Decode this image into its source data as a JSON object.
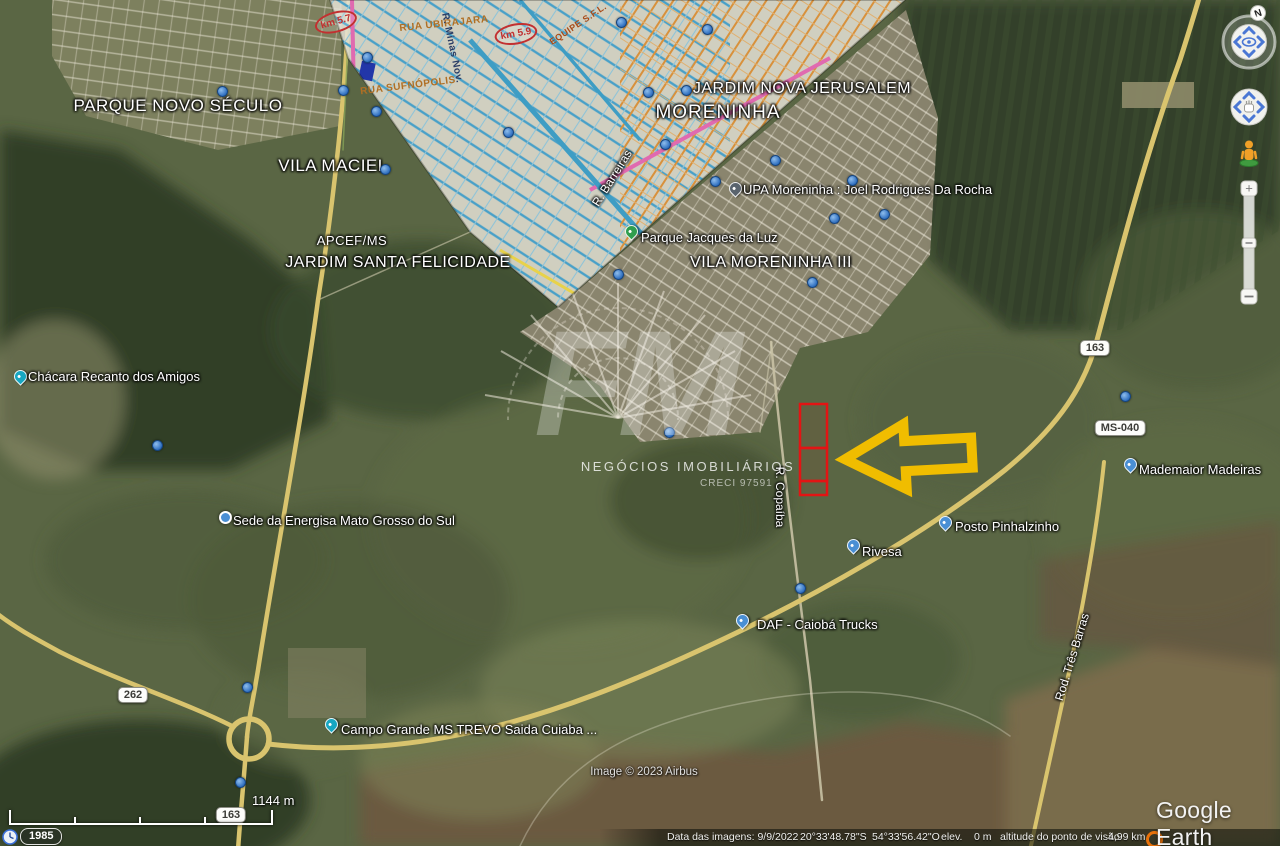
{
  "app": {
    "logo_text": "Google Earth",
    "compass_n": "N"
  },
  "colors": {
    "parcel_outline": "#e31414",
    "arrow": "#f0bd00",
    "road": "#d9c46e",
    "photo_icon_blue": "#2f6fc0"
  },
  "watermark": {
    "logo": "FM",
    "line1": "NEGÓCIOS IMOBILIÁRIOS",
    "line2": "CRECI 97591"
  },
  "scale": {
    "distance": "1144 m"
  },
  "history": {
    "year": "1985"
  },
  "status": {
    "imagery": "Data das imagens: 9/9/2022",
    "lat": "20°33'48.78\"S",
    "lon": "54°33'56.42\"O",
    "elev_label": "elev.",
    "elev": "0 m",
    "view_alt_label": "altitude do ponto de visão",
    "view_alt": "4,99 km"
  },
  "credit": "Image © 2023 Airbus",
  "regions": [
    {
      "text": "PARQUE NOVO SÉCULO"
    },
    {
      "text": "VILA MACIEL"
    },
    {
      "text": "APCEF/MS"
    },
    {
      "text": "JARDIM SANTA FELICIDADE"
    },
    {
      "text": "JARDIM NOVA JERUSALEM"
    },
    {
      "text": "MORENINHA"
    },
    {
      "text": "VILA MORENINHA III"
    }
  ],
  "pois": [
    {
      "text": "Chácara Recanto dos Amigos",
      "pin": "lodging-pin"
    },
    {
      "text": "UPA Moreninha : Joel Rodrigues Da Rocha",
      "pin": "hospital-pin"
    },
    {
      "text": "Parque Jacques da Luz",
      "pin": "park-pin"
    },
    {
      "text": "Sede da Energisa Mato Grosso do Sul",
      "pin": "dot-pin"
    },
    {
      "text": "Rivesa",
      "pin": "business-pin"
    },
    {
      "text": "Posto Pinhalzinho",
      "pin": "gas-pin"
    },
    {
      "text": "Mademaior Madeiras",
      "pin": "business-pin"
    },
    {
      "text": "DAF - Caiobá Trucks",
      "pin": "truck-pin"
    },
    {
      "text": "Campo Grande MS TREVO Saida Cuiaba ...",
      "pin": "lodging-pin"
    }
  ],
  "streets": [
    {
      "text": "R. Barreiras"
    },
    {
      "text": "R. Copaíba"
    },
    {
      "text": "Rod. Três Barras"
    }
  ],
  "shields": [
    {
      "text": "163"
    },
    {
      "text": "MS-040"
    },
    {
      "text": "262"
    },
    {
      "text": "163"
    }
  ],
  "overlay_map": [
    {
      "text": "km 5.7"
    },
    {
      "text": "km 5.9"
    },
    {
      "text": "RUA UBIRAJARA"
    },
    {
      "text": "RUA SUFNÓPOLIS"
    },
    {
      "text": "R. Minas Nov."
    },
    {
      "text": "EQUIPE S.F.L."
    }
  ]
}
